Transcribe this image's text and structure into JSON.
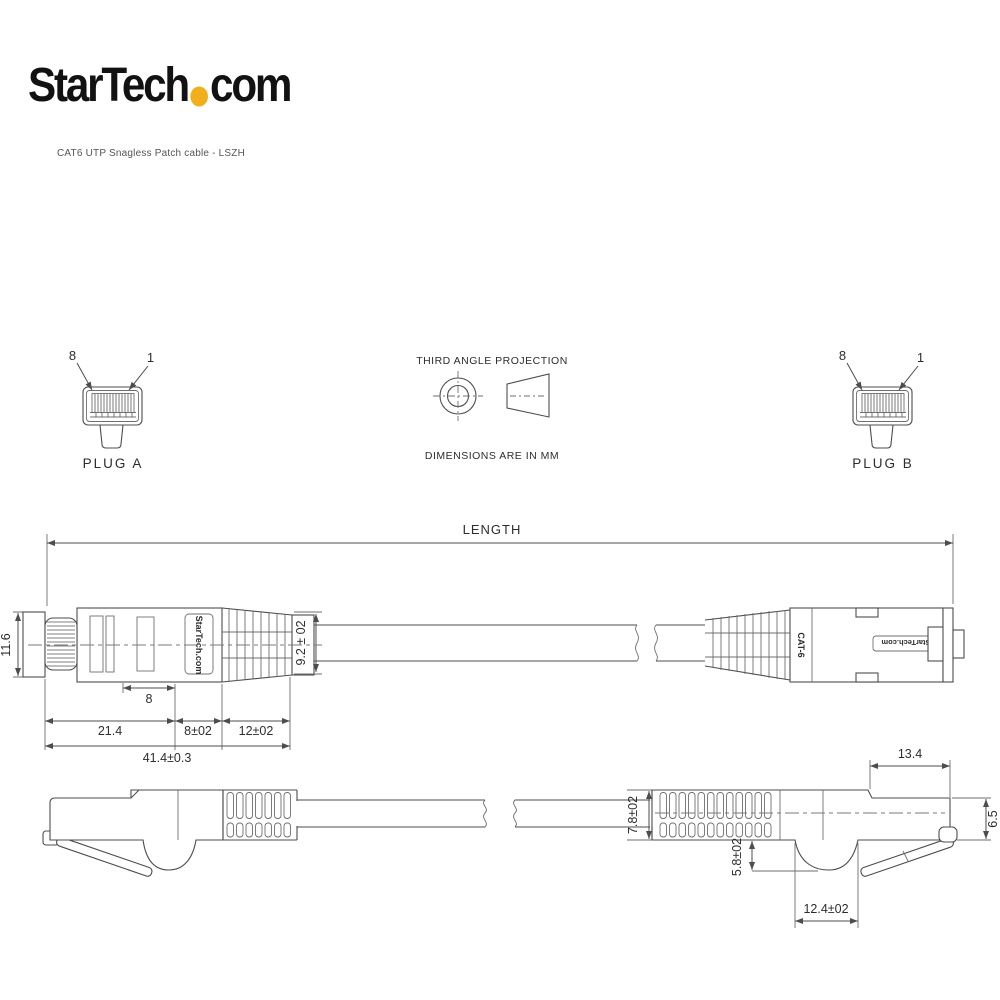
{
  "brand": {
    "name_pre": "StarTech",
    "name_post": "com",
    "dot_color": "#F1B01B",
    "subtitle": "CAT6 UTP Snagless Patch cable - LSZH"
  },
  "projection": {
    "title": "THIRD ANGLE PROJECTION",
    "note": "DIMENSIONS ARE IN MM"
  },
  "plugs": {
    "a_label": "PLUG A",
    "b_label": "PLUG B",
    "pin_first": "8",
    "pin_last": "1"
  },
  "top_view": {
    "length_label": "LENGTH",
    "height": "11.6",
    "boot_exit_od": "9.2 ± 02",
    "contact_len": "8",
    "body_len": "21.4",
    "boot_len_1": "8±02",
    "boot_len_2": "12±02",
    "overall_len": "41.4±0.3",
    "boot_marking": "StarTech.com",
    "cat_marking": "CAT-6",
    "body_marking": "StarTech.com"
  },
  "side_view": {
    "boot_od": "7.8±02",
    "latch_len": "13.4",
    "plug_height": "6.5",
    "bump_depth": "5.8±02",
    "bump_len": "12.4±02"
  }
}
